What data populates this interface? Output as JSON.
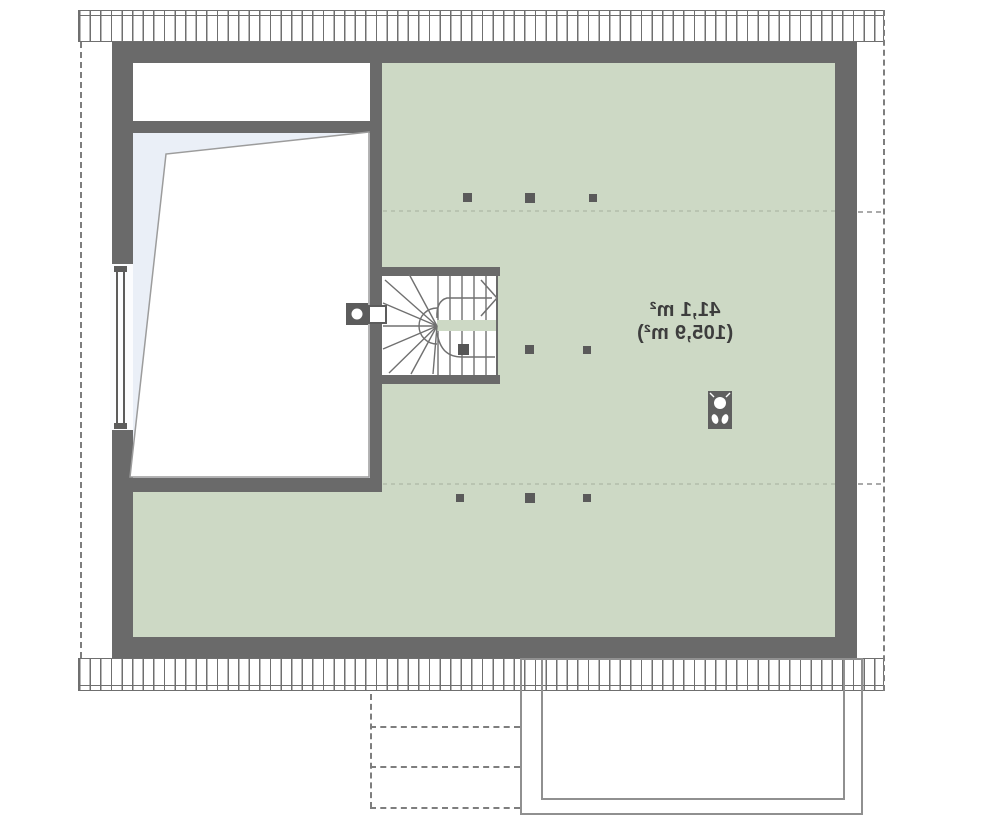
{
  "floor_plan": {
    "area_labels": {
      "line1": "41,1 m²",
      "line2": "(105,9 m²)"
    },
    "colors": {
      "floor_green": "#cdd9c5",
      "floor_blue": "#eaeff7",
      "wall_gray": "#6a6a6a",
      "stair_line_gray": "#707070",
      "dashed_outline_gray": "#7e7e7e",
      "faint_ceiling_dash_green": "#b6c1ae",
      "label_text": "#3d3d3d"
    },
    "icons": {
      "chimney": "chimney-icon",
      "ventilation": "vent-icon",
      "window": "window-icon",
      "door_leaf": "door-leaf",
      "stair_direction": "stair-arrow-icon",
      "posts": "column-marker",
      "roof_eaves": "roof-eaves-hatch",
      "roof_outline": "roof-outline-dashed",
      "terrace": "terrace-outline",
      "terrace_steps": "terrace-steps-dashed"
    }
  }
}
